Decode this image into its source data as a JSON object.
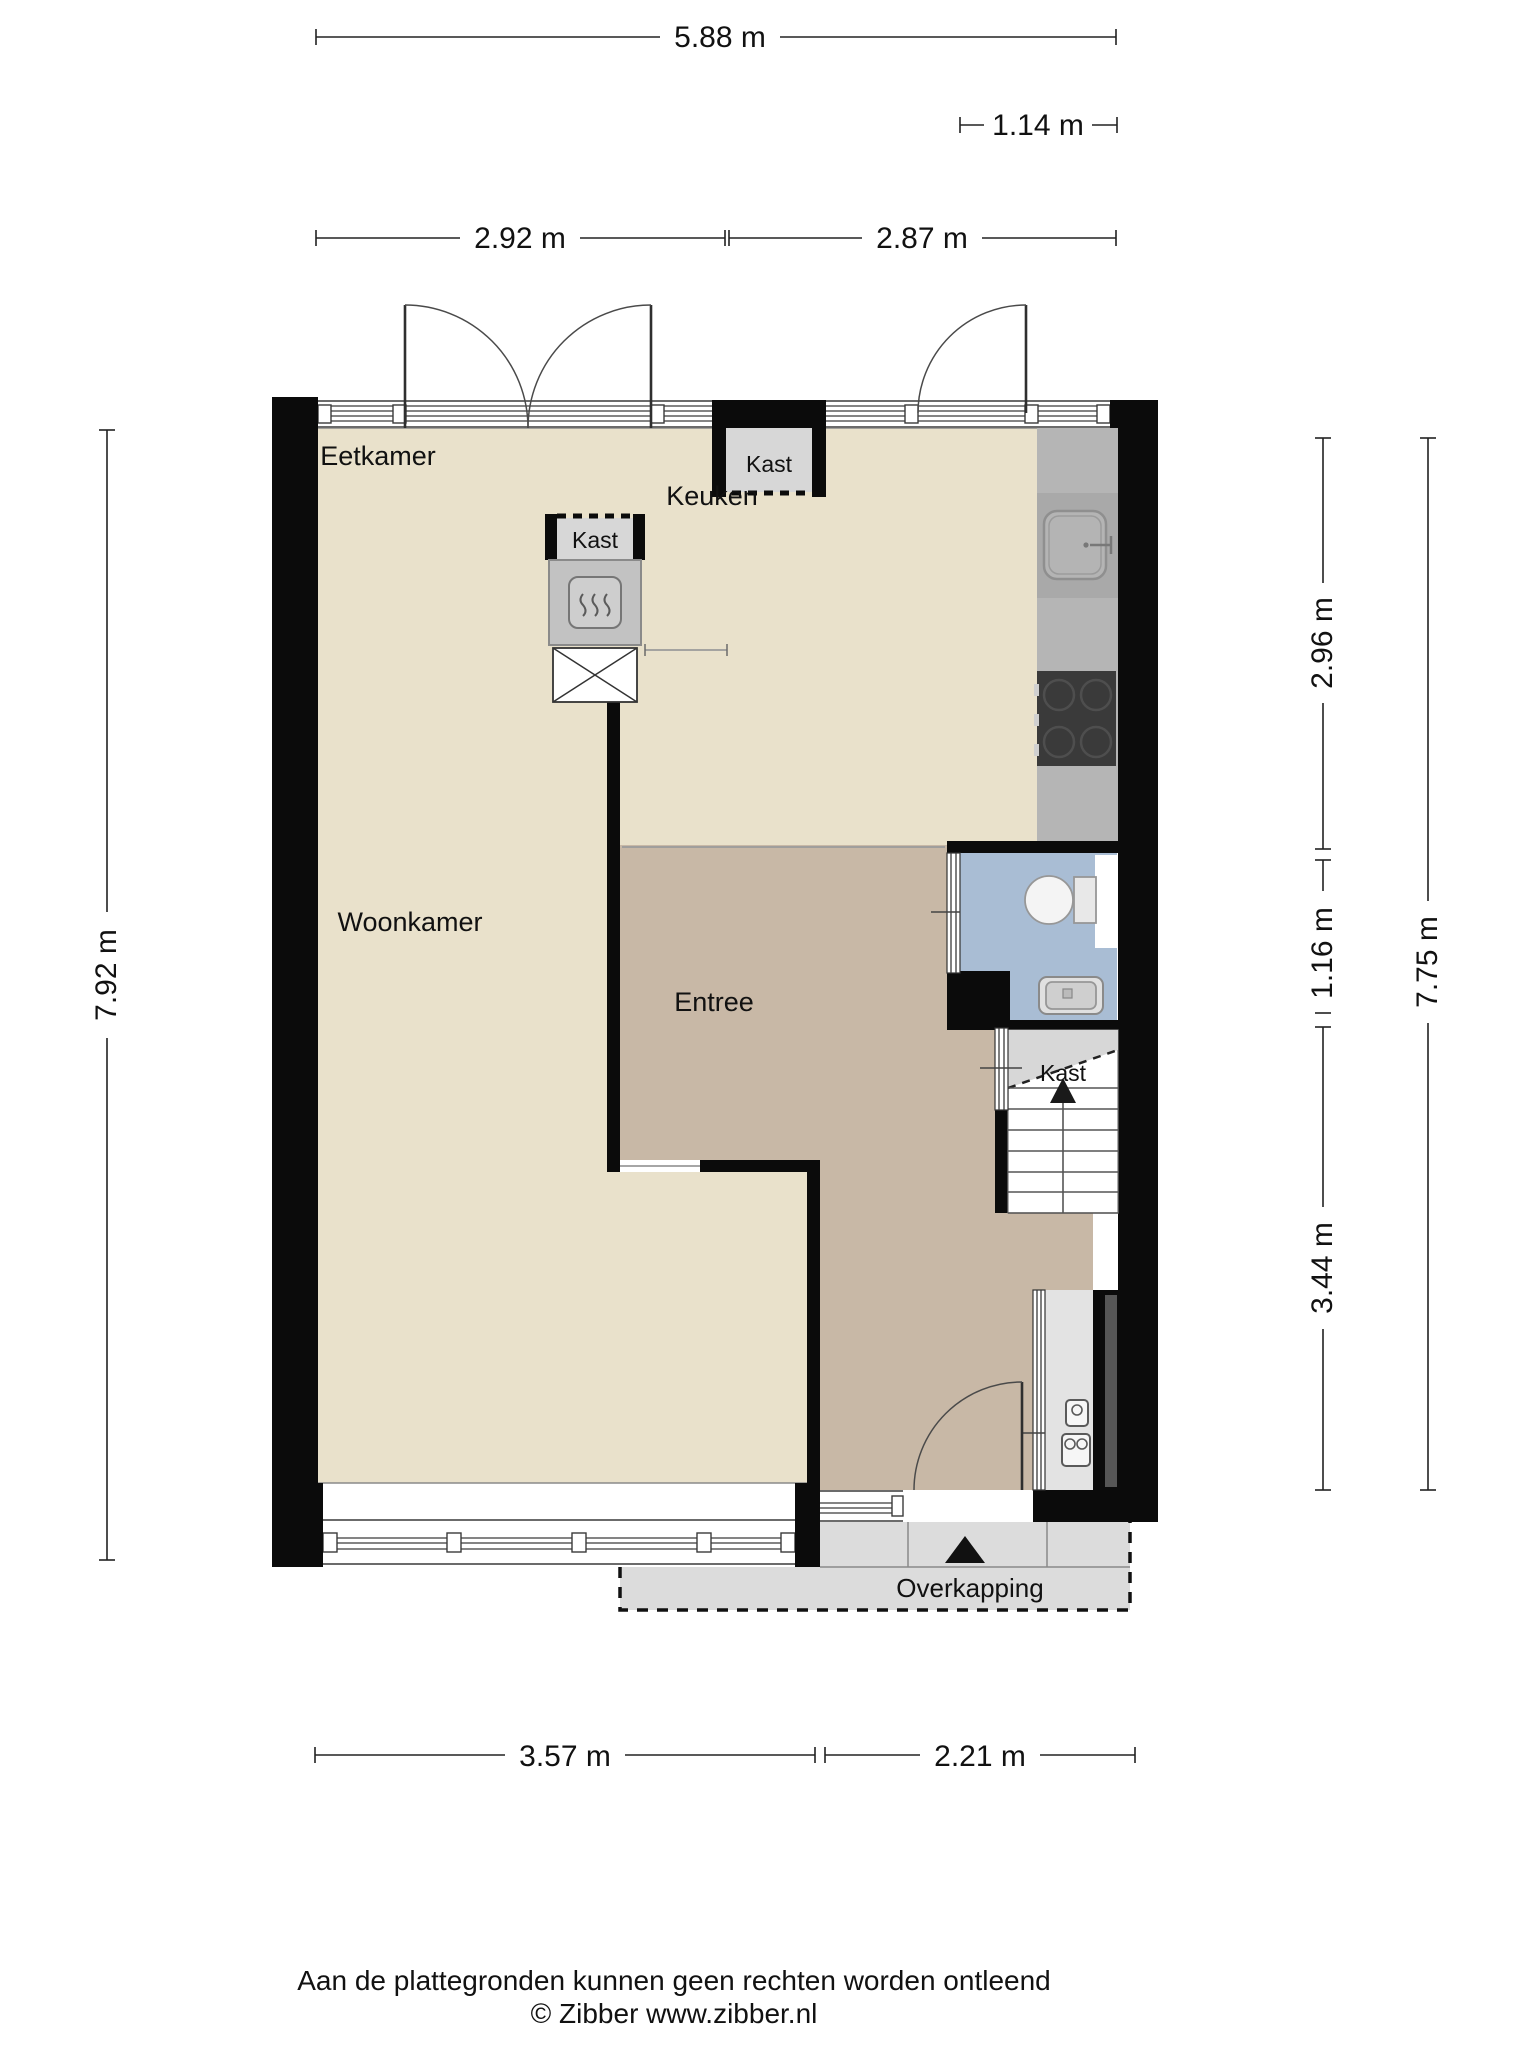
{
  "labels": {
    "eetkamer": "Eetkamer",
    "keuken": "Keuken",
    "woonkamer": "Woonkamer",
    "entree": "Entree",
    "kast": "Kast",
    "overkapping": "Overkapping"
  },
  "dimensions": {
    "top_total": "5.88 m",
    "top_right_inset": "1.14 m",
    "top_left": "2.92 m",
    "top_right": "2.87 m",
    "left_total": "7.92 m",
    "right_upper": "2.96 m",
    "right_middle": "1.16 m",
    "right_lower": "3.44 m",
    "right_total": "7.75 m",
    "bottom_left": "3.57 m",
    "bottom_right": "2.21 m"
  },
  "footer": {
    "disclaimer": "Aan de plattegronden kunnen geen rechten worden ontleend",
    "copyright": "© Zibber www.zibber.nl"
  },
  "colors": {
    "wall": "#0b0b0b",
    "floor_living": "#e9e1cb",
    "floor_hall": "#c8b8a6",
    "floor_toilet": "#a9bdd4",
    "counter": "#b5b5b5",
    "counter_sink_zone": "#a9a9a9",
    "cooktop": "#3a3a3a",
    "closet": "#d7d7d7",
    "canopy": "#dcdcdc",
    "meter_cupboard": "#e3e3e3"
  }
}
